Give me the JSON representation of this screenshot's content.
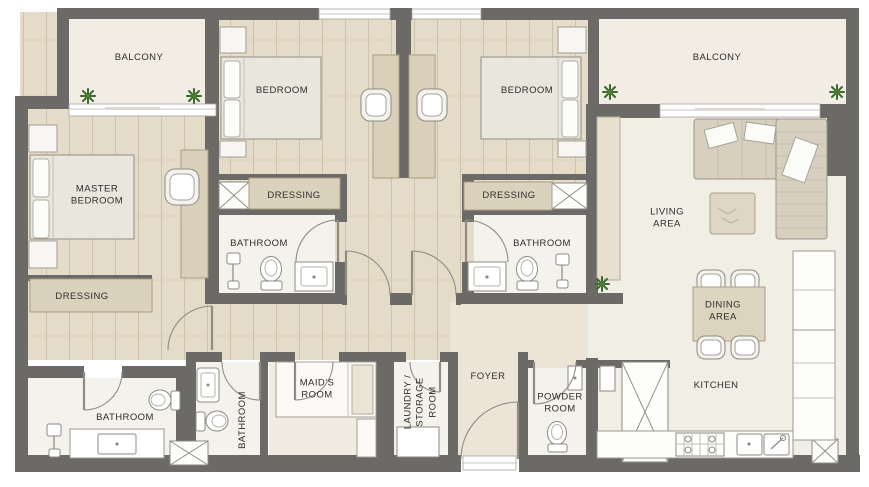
{
  "plan": {
    "type": "apartment-floor-plan",
    "palette": {
      "wall": "#6c6a67",
      "wood_floor": "#e4dbc8",
      "light_floor": "#f2efe7",
      "foyer_floor": "#ece4d6",
      "furniture_wood": "#dbd2bd",
      "plant_green": "#3c6a2d",
      "label_text": "#2e2d2b"
    },
    "rooms": {
      "balcony_left": "BALCONY",
      "balcony_right": "BALCONY",
      "bedroom_left": "BEDROOM",
      "bedroom_right": "BEDROOM",
      "master_bedroom": "MASTER\nBEDROOM",
      "master_dressing": "DRESSING",
      "dressing_left": "DRESSING",
      "dressing_right": "DRESSING",
      "bathroom_left": "BATHROOM",
      "bathroom_right": "BATHROOM",
      "master_bathroom": "BATHROOM",
      "maids_bathroom": "BATHROOM",
      "living_area": "LIVING\nAREA",
      "dining_area": "DINING\nAREA",
      "kitchen": "KITCHEN",
      "foyer": "FOYER",
      "maids_room": "MAID'S\nROOM",
      "laundry_storage": "LAUNDRY /\nSTORAGE\nROOM",
      "powder_room": "POWDER\nROOM"
    }
  }
}
